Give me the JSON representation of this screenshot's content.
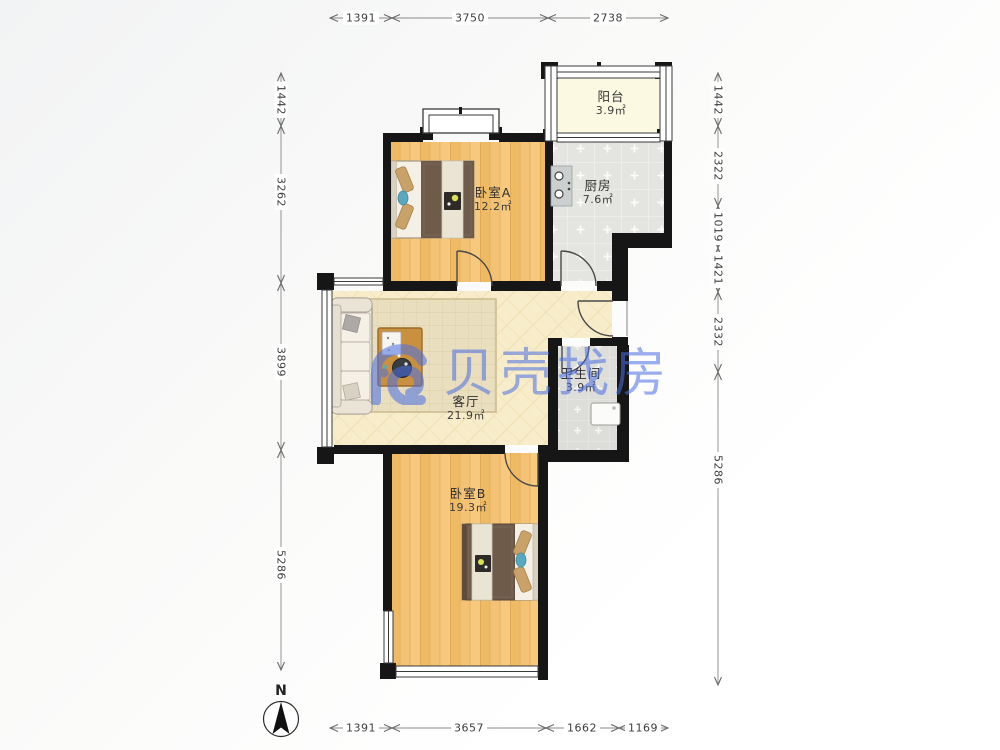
{
  "watermark": {
    "text": "贝壳找房",
    "color": "#4A6FE5"
  },
  "compass": {
    "label": "N"
  },
  "rooms": [
    {
      "id": "balcony",
      "name": "阳台",
      "area": "3.9㎡"
    },
    {
      "id": "kitchen",
      "name": "厨房",
      "area": "7.6㎡"
    },
    {
      "id": "bedroom-a",
      "name": "卧室A",
      "area": "12.2㎡"
    },
    {
      "id": "living-room",
      "name": "客厅",
      "area": "21.9㎡"
    },
    {
      "id": "bathroom",
      "name": "卫生间",
      "area": "3.9㎡"
    },
    {
      "id": "bedroom-b",
      "name": "卧室B",
      "area": "19.3㎡"
    }
  ],
  "dimensions": {
    "top": [
      "1391",
      "3750",
      "2738"
    ],
    "bottom": [
      "1391",
      "3657",
      "1662",
      "1169"
    ],
    "left": [
      "1442",
      "3262",
      "3899",
      "5286"
    ],
    "right": [
      "1442",
      "2322",
      "1019",
      "1421",
      "2332",
      "5286"
    ]
  },
  "colors": {
    "wall": "#161616",
    "wood_floor": "#F3C274",
    "kitchen_tile": "#E4E4E1",
    "bath_tile": "#DDDDD9",
    "living_tile": "#F8EDCA",
    "balcony_floor": "#FCF9E2",
    "watermark_blue": "#4A6FE5"
  }
}
